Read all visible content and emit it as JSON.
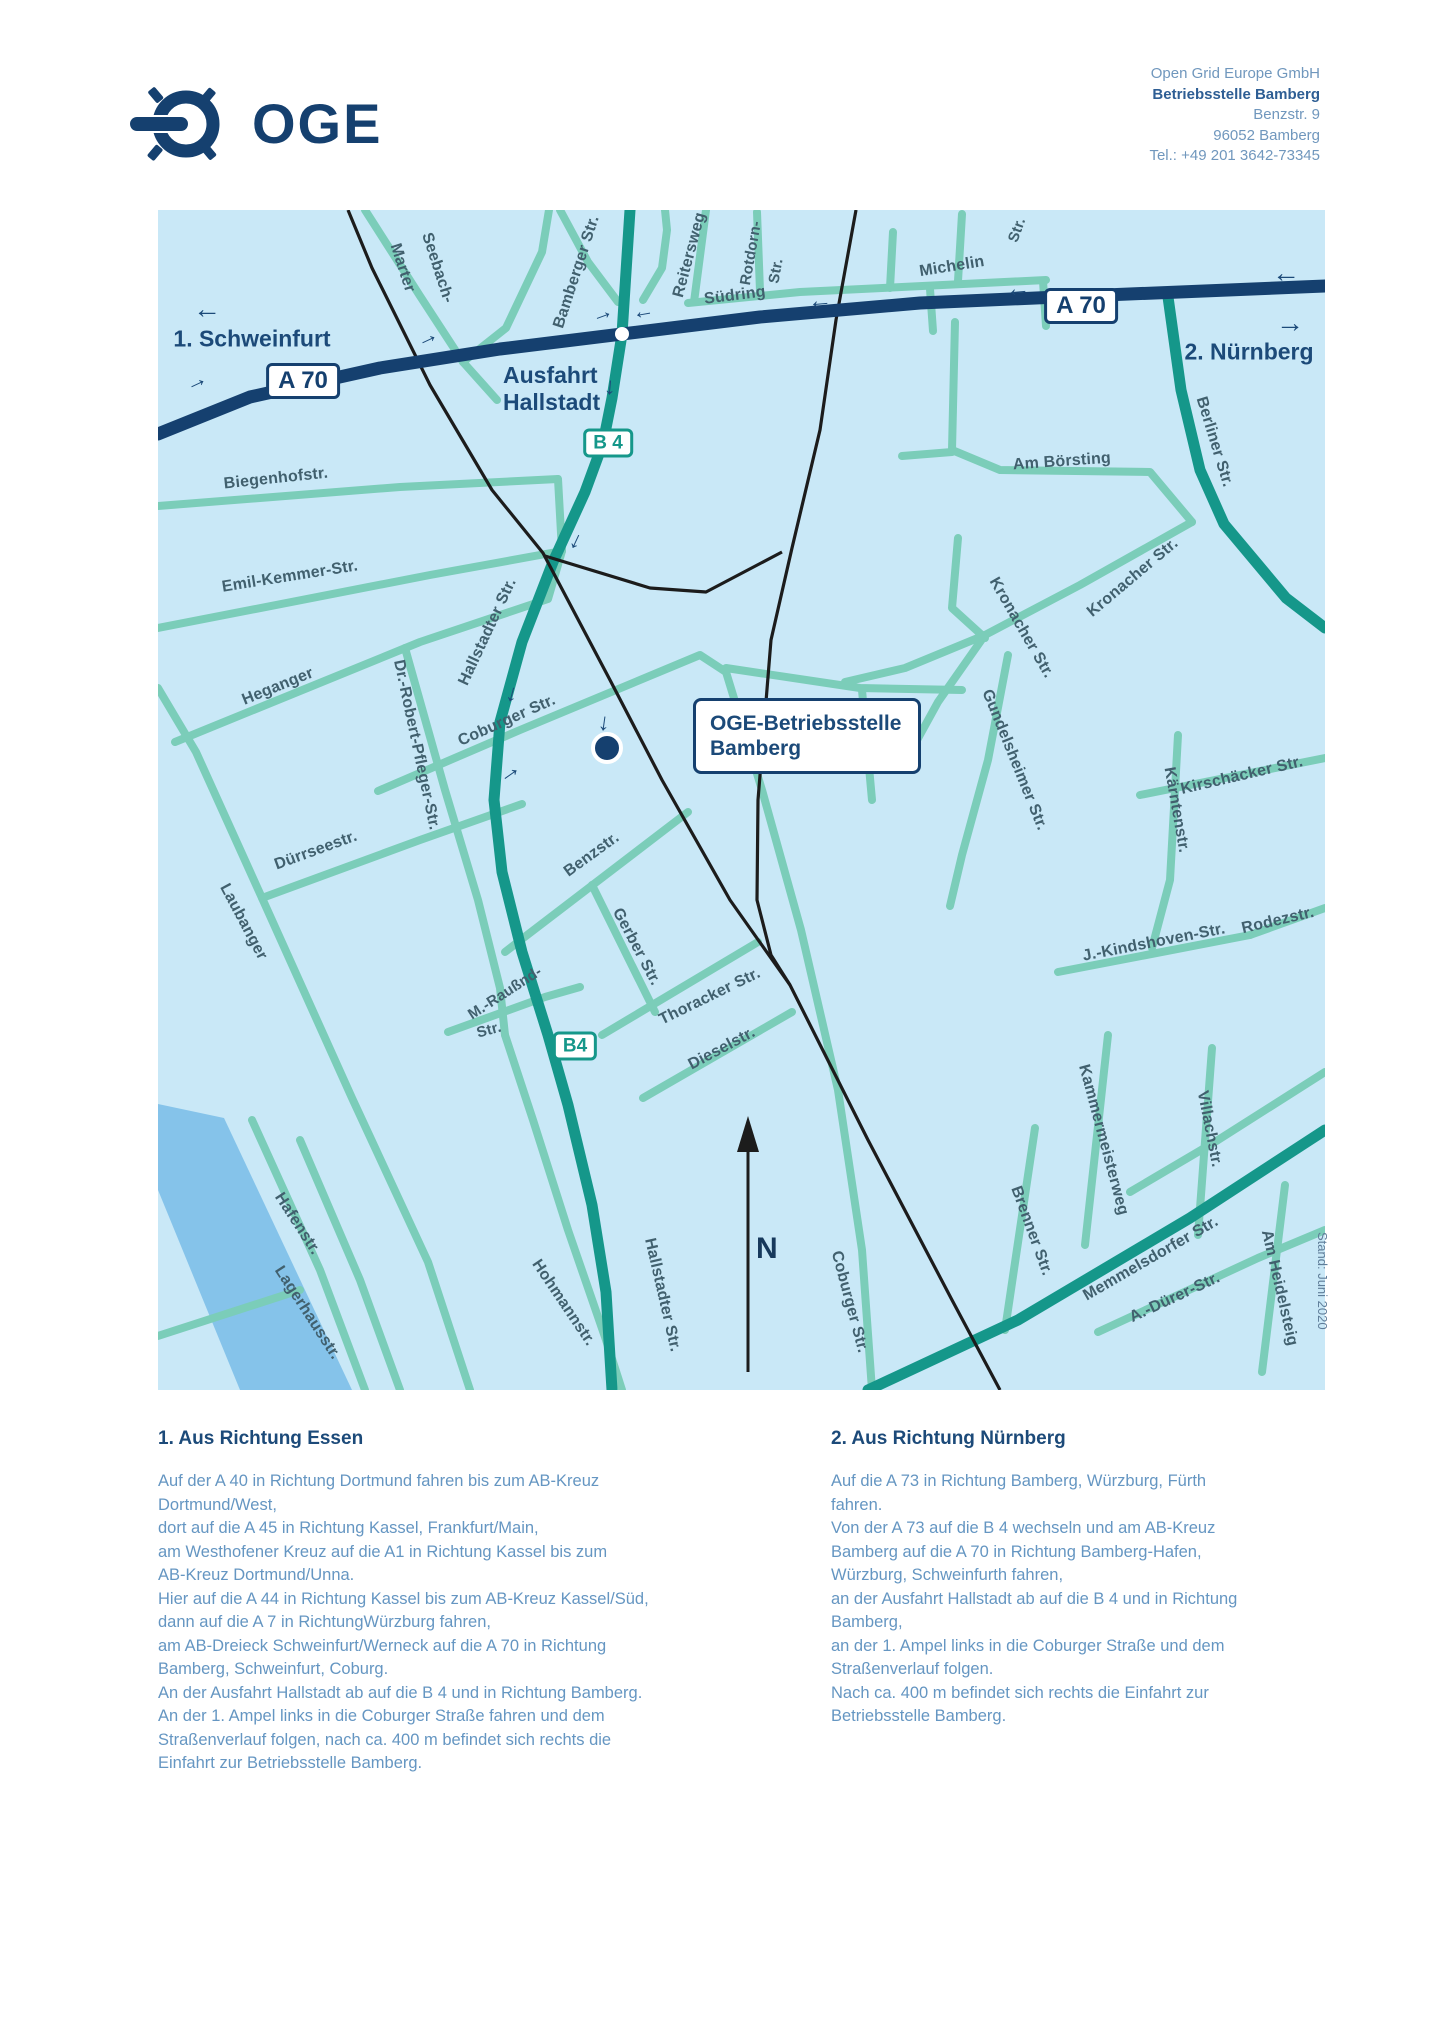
{
  "header": {
    "logo_text": "OGE",
    "address": {
      "line1": "Open Grid Europe GmbH",
      "line2": "Betriebsstelle Bamberg",
      "line3": "Benzstr. 9",
      "line4": "96052 Bamberg",
      "line5": "Tel.: +49 201 3642-73345"
    }
  },
  "map": {
    "region_labels": [
      {
        "text": "1. Schweinfurt",
        "x": 252,
        "y": 339,
        "size": 23
      },
      {
        "text": "2. Nürnberg",
        "x": 1249,
        "y": 352,
        "size": 23
      }
    ],
    "ausfahrt": {
      "line1": "Ausfahrt",
      "line2": "Hallstadt"
    },
    "callout": {
      "line1": "OGE-Betriebsstelle",
      "line2": "Bamberg"
    },
    "compass_label": "N",
    "stand_note": "Stand: Juni 2020",
    "badges": [
      {
        "text": "A 70",
        "x": 303,
        "y": 381,
        "type": "motorway"
      },
      {
        "text": "A 70",
        "x": 1081,
        "y": 306,
        "type": "motorway"
      },
      {
        "text": "B 4",
        "x": 608,
        "y": 443,
        "type": "bundes"
      },
      {
        "text": "B4",
        "x": 575,
        "y": 1046,
        "type": "bundes"
      }
    ],
    "street_labels": [
      {
        "text": "Marter",
        "x": 402,
        "y": 268,
        "rot": 72,
        "size": 16
      },
      {
        "text": "Seebach-",
        "x": 437,
        "y": 268,
        "rot": 72,
        "size": 16
      },
      {
        "text": "Bamberger Str.",
        "x": 577,
        "y": 272,
        "rot": -72,
        "size": 16
      },
      {
        "text": "Reitersweg",
        "x": 690,
        "y": 255,
        "rot": -75,
        "size": 16
      },
      {
        "text": "Südring",
        "x": 735,
        "y": 296,
        "rot": -7,
        "size": 16
      },
      {
        "text": "Rotdorn-",
        "x": 751,
        "y": 253,
        "rot": -80,
        "size": 15
      },
      {
        "text": "Str.",
        "x": 776,
        "y": 271,
        "rot": -80,
        "size": 15
      },
      {
        "text": "Michelin",
        "x": 952,
        "y": 267,
        "rot": -9,
        "size": 16
      },
      {
        "text": "Str.",
        "x": 1017,
        "y": 230,
        "rot": -70,
        "size": 15
      },
      {
        "text": "Am Börsting",
        "x": 1062,
        "y": 462,
        "rot": -4,
        "size": 16
      },
      {
        "text": "Berliner Str.",
        "x": 1214,
        "y": 442,
        "rot": 73,
        "size": 16
      },
      {
        "text": "Biegenhofstr.",
        "x": 276,
        "y": 479,
        "rot": -6,
        "size": 16
      },
      {
        "text": "Emil-Kemmer-Str.",
        "x": 290,
        "y": 577,
        "rot": -9,
        "size": 16
      },
      {
        "text": "Heganger",
        "x": 278,
        "y": 687,
        "rot": -22,
        "size": 16
      },
      {
        "text": "Hallstadter Str.",
        "x": 488,
        "y": 632,
        "rot": -65,
        "size": 16
      },
      {
        "text": "Coburger Str.",
        "x": 507,
        "y": 721,
        "rot": -24,
        "size": 16
      },
      {
        "text": "Dürrseestr.",
        "x": 316,
        "y": 851,
        "rot": -20,
        "size": 16
      },
      {
        "text": "Laubanger",
        "x": 243,
        "y": 922,
        "rot": 62,
        "size": 16
      },
      {
        "text": "Dr.-Robert-Pfleger-Str.",
        "x": 416,
        "y": 745,
        "rot": 78,
        "size": 16
      },
      {
        "text": "M.-Raußnd-",
        "x": 505,
        "y": 993,
        "rot": -33,
        "size": 15
      },
      {
        "text": "Str.",
        "x": 489,
        "y": 1030,
        "rot": -15,
        "size": 15
      },
      {
        "text": "Benzstr.",
        "x": 592,
        "y": 855,
        "rot": -36,
        "size": 16
      },
      {
        "text": "Gerber Str.",
        "x": 636,
        "y": 947,
        "rot": 62,
        "size": 16
      },
      {
        "text": "Thoracker Str.",
        "x": 710,
        "y": 997,
        "rot": -26,
        "size": 16
      },
      {
        "text": "Dieselstr.",
        "x": 722,
        "y": 1049,
        "rot": -28,
        "size": 16
      },
      {
        "text": "Kronacher Str.",
        "x": 1021,
        "y": 628,
        "rot": 60,
        "size": 16
      },
      {
        "text": "Kronacher Str.",
        "x": 1133,
        "y": 578,
        "rot": -40,
        "size": 16
      },
      {
        "text": "Gundelsheimer Str.",
        "x": 1014,
        "y": 760,
        "rot": 68,
        "size": 16
      },
      {
        "text": "Kärntenstr.",
        "x": 1176,
        "y": 810,
        "rot": 80,
        "size": 16
      },
      {
        "text": "Kirschäcker Str.",
        "x": 1242,
        "y": 776,
        "rot": -13,
        "size": 16
      },
      {
        "text": "J.-Kindshoven-Str.",
        "x": 1154,
        "y": 943,
        "rot": -11,
        "size": 16
      },
      {
        "text": "Rodezstr.",
        "x": 1278,
        "y": 921,
        "rot": -13,
        "size": 16
      },
      {
        "text": "Kammermeisterweg",
        "x": 1103,
        "y": 1140,
        "rot": 75,
        "size": 16
      },
      {
        "text": "Villachstr.",
        "x": 1209,
        "y": 1129,
        "rot": 79,
        "size": 16
      },
      {
        "text": "Brenner Str.",
        "x": 1031,
        "y": 1231,
        "rot": 70,
        "size": 16
      },
      {
        "text": "Memmelsdorfer Str.",
        "x": 1151,
        "y": 1259,
        "rot": -30,
        "size": 16
      },
      {
        "text": "A.-Dürer-Str.",
        "x": 1175,
        "y": 1298,
        "rot": -25,
        "size": 16
      },
      {
        "text": "Am Heidelsteig",
        "x": 1279,
        "y": 1288,
        "rot": 77,
        "size": 16
      },
      {
        "text": "Hafenstr.",
        "x": 297,
        "y": 1224,
        "rot": 57,
        "size": 16
      },
      {
        "text": "Lagerhausstr.",
        "x": 307,
        "y": 1313,
        "rot": 57,
        "size": 16
      },
      {
        "text": "Hohmannstr.",
        "x": 563,
        "y": 1303,
        "rot": 56,
        "size": 16
      },
      {
        "text": "Hallstadter Str.",
        "x": 662,
        "y": 1295,
        "rot": 77,
        "size": 16
      },
      {
        "text": "Coburger Str.",
        "x": 849,
        "y": 1302,
        "rot": 75,
        "size": 16
      }
    ],
    "arrows": [
      {
        "c": "←",
        "x": 207,
        "y": 309,
        "rot": 0,
        "s": 28
      },
      {
        "c": "→",
        "x": 196,
        "y": 381,
        "rot": -25,
        "s": 22
      },
      {
        "c": "→",
        "x": 427,
        "y": 337,
        "rot": -25,
        "s": 22
      },
      {
        "c": "→",
        "x": 602,
        "y": 313,
        "rot": -20,
        "s": 22
      },
      {
        "c": "←",
        "x": 643,
        "y": 311,
        "rot": -10,
        "s": 22
      },
      {
        "c": "↓",
        "x": 610,
        "y": 387,
        "rot": 5,
        "s": 24
      },
      {
        "c": "↓",
        "x": 576,
        "y": 541,
        "rot": 25,
        "s": 24
      },
      {
        "c": "↓",
        "x": 512,
        "y": 694,
        "rot": 15,
        "s": 24
      },
      {
        "c": "↓",
        "x": 604,
        "y": 723,
        "rot": 8,
        "s": 24
      },
      {
        "c": "→",
        "x": 509,
        "y": 772,
        "rot": -35,
        "s": 24
      },
      {
        "c": "←",
        "x": 820,
        "y": 301,
        "rot": -5,
        "s": 24
      },
      {
        "c": "←",
        "x": 1018,
        "y": 289,
        "rot": -5,
        "s": 24
      },
      {
        "c": "←",
        "x": 1286,
        "y": 273,
        "rot": 0,
        "s": 28
      },
      {
        "c": "→",
        "x": 1290,
        "y": 323,
        "rot": 0,
        "s": 28
      }
    ]
  },
  "directions": {
    "col1": {
      "heading": "1. Aus Richtung Essen",
      "body": "Auf der A 40 in Richtung Dortmund fahren bis zum AB-Kreuz\nDortmund/West,\ndort auf die A 45 in Richtung Kassel, Frankfurt/Main,\nam Westhofener Kreuz auf die A1 in Richtung Kassel bis zum\nAB-Kreuz Dortmund/Unna.\nHier auf die A 44 in Richtung Kassel bis zum AB-Kreuz Kassel/Süd,\ndann auf die A 7 in RichtungWürzburg fahren,\nam AB-Dreieck Schweinfurt/Werneck auf die A 70 in Richtung\nBamberg, Schweinfurt, Coburg.\nAn der Ausfahrt Hallstadt ab auf die B 4 und in Richtung Bamberg.\nAn der 1. Ampel links in die Coburger Straße fahren und dem\nStraßenverlauf folgen, nach ca. 400 m befindet sich rechts die\nEinfahrt zur Betriebsstelle Bamberg."
    },
    "col2": {
      "heading": "2. Aus Richtung Nürnberg",
      "body": "Auf die A 73 in Richtung Bamberg, Würzburg, Fürth\nfahren.\nVon der A 73 auf die B 4 wechseln und am AB-Kreuz\nBamberg auf die A 70 in Richtung Bamberg-Hafen,\nWürzburg, Schweinfurth fahren,\nan der Ausfahrt Hallstadt ab auf die B 4 und in Richtung\nBamberg,\nan der 1. Ampel links in die Coburger Straße und dem\nStraßenverlauf folgen.\nNach ca. 400 m befindet sich rechts die Einfahrt zur\nBetriebsstelle Bamberg."
    }
  },
  "colors": {
    "navy": "#15406f",
    "label_navy": "#1c4a79",
    "street_label": "#41606e",
    "body_blue": "#6596c2",
    "map_bg": "#c9e8f7",
    "road_minor": "#7bcdb9",
    "road_bundes": "#15978a",
    "rail_black": "#1c1c1c",
    "water_blue": "#85c3ea"
  }
}
